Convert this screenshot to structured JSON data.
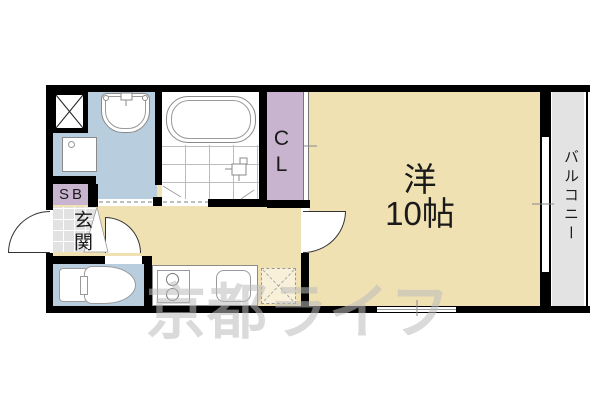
{
  "floorplan": {
    "rooms": {
      "main_room_name": "洋",
      "main_room_size": "10帖",
      "closet_label": "CL",
      "balcony_label": "バルコニー",
      "entrance_label": "玄関",
      "shoe_box_label": "SB"
    },
    "watermark": "京都ライフ",
    "colors": {
      "room_beige": "#f0e1b2",
      "wet_area_blue": "#b8cede",
      "storage_purple": "#c9b4cf",
      "balcony_gray": "#e3e3e3",
      "entrance_tile_gray": "#e2e2e2",
      "wall_black": "#000000",
      "watermark_gray": "#bdbdbd"
    },
    "fixtures": [
      "pipe-space",
      "wash-basin",
      "washing-machine-pan",
      "bathtub",
      "shower-faucet",
      "toilet",
      "kitchen-stove",
      "kitchen-sink",
      "refrigerator-space",
      "sliding-window",
      "doors"
    ]
  }
}
